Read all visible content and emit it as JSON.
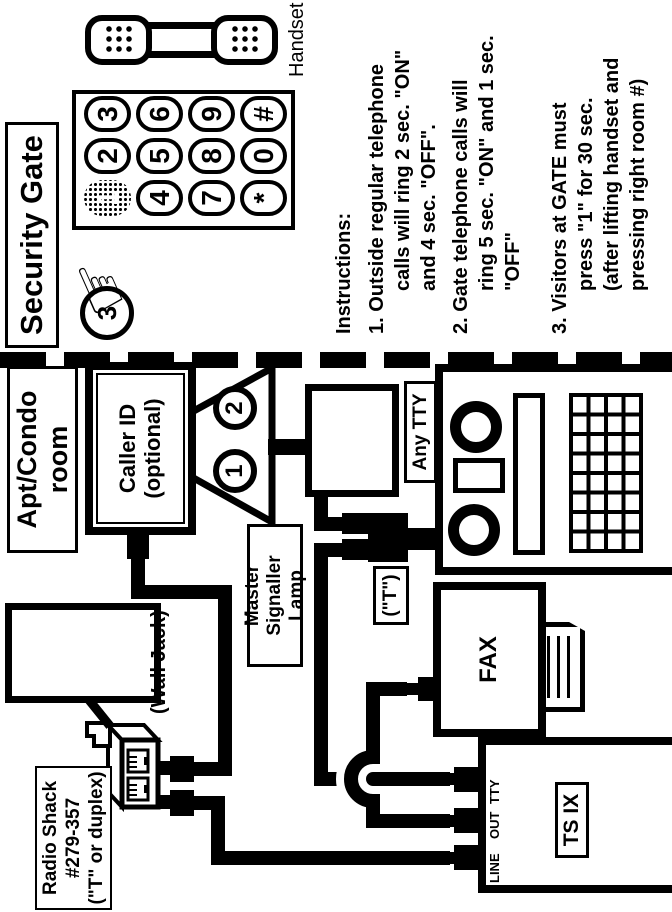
{
  "colors": {
    "ink": "#000000",
    "paper": "#ffffff"
  },
  "gate_panel": {
    "title": "Security Gate",
    "handset_label": "Handset",
    "step_badge": "3",
    "pressed_key": "1",
    "keypad_keys": [
      "1",
      "2",
      "3",
      "4",
      "5",
      "6",
      "7",
      "8",
      "9",
      "*",
      "0",
      "#"
    ],
    "instructions": {
      "heading": "Instructions:",
      "lines": [
        "1. Outside regular telephone",
        "calls will ring 2 sec. \"ON\"",
        "and 4 sec. \"OFF\".",
        "2. Gate telephone calls will",
        "ring 5 sec. \"ON\" and 1 sec.",
        "\"OFF\"",
        "3. Visitors at GATE must",
        "press \"1\" for 30 sec.",
        "(after lifting handset and",
        "pressing right room #)"
      ]
    }
  },
  "room_panel": {
    "title_lines": [
      "Apt/Condo",
      "room"
    ],
    "caller_id_lines": [
      "Caller ID",
      "(optional)"
    ],
    "lamp_bulbs": [
      "1",
      "2"
    ],
    "master_lamp_label_lines": [
      "Master Signaller",
      "Lamp"
    ],
    "wall_jack_label": "(Wall Jack)",
    "adapter_label_lines": [
      "Radio Shack",
      "#279-357",
      "(\"T\" or duplex)"
    ],
    "any_tty_label": "Any TTY",
    "t_adapter_label": "(\"T\")",
    "fax_label": "FAX",
    "ts_ix": {
      "label": "TS IX",
      "ports": [
        "LINE",
        "OUT",
        "TTY"
      ]
    }
  }
}
